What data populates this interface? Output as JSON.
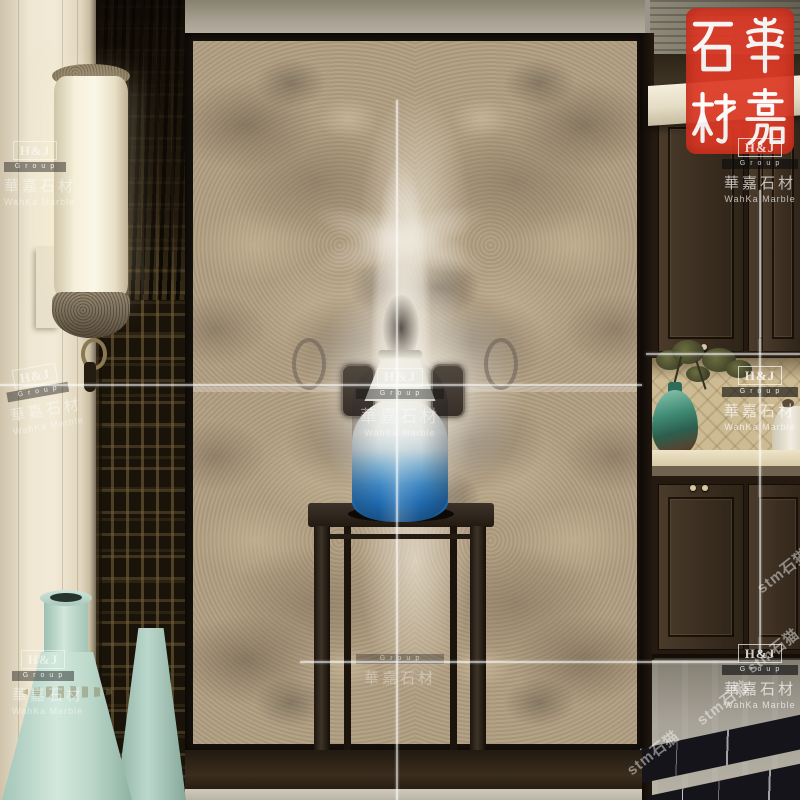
{
  "scene": {
    "label": "Interior showroom photo: bookmatched marble feature wall with blue gradient vase on dark wood stand, Chinese lattice screen and wall lamp at left, dark wood cabinets with decor niche at right"
  },
  "seal": {
    "brand_cjk": "華嘉石材",
    "characters": [
      "石",
      "華",
      "材",
      "嘉"
    ],
    "background_color": "#dd3a26",
    "text_color": "#ffffff"
  },
  "watermarks": {
    "hj": {
      "logo": "H&J",
      "group": "Group",
      "cjk": "華嘉石材",
      "en": "WahKa Marble"
    },
    "diagonal": {
      "text": "stm石猫"
    }
  },
  "palette": {
    "marble_base": "#b19e81",
    "marble_vein": "#ece6d8",
    "wood_dark": "#3a2d20",
    "vase_blue": "#1f6bb0",
    "vase_white": "#f2f1ea",
    "celadon": "#bcd6cb",
    "seal_red": "#dd3a26",
    "lamp_ivory": "#f7f1dd",
    "floor_gray": "#b0aba0",
    "skirting_black": "#15151a"
  }
}
